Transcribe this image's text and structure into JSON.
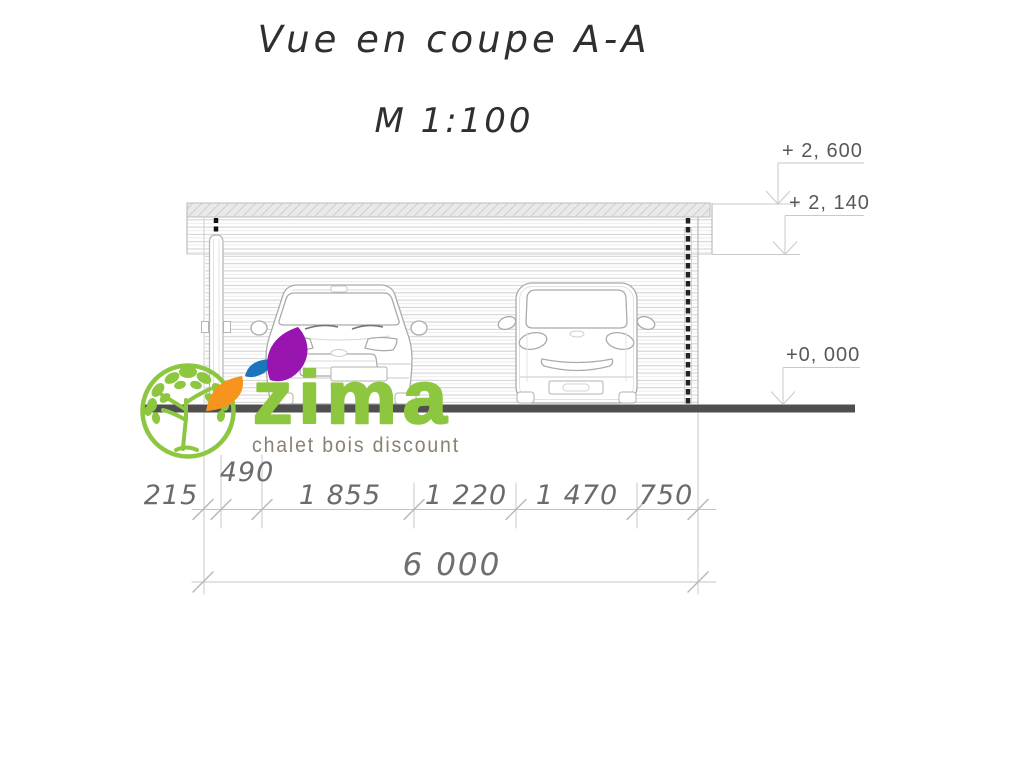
{
  "title": {
    "heading": "Vue en coupe A-A",
    "scale": "M 1:100"
  },
  "elevation_markers": [
    {
      "label": "+ 2, 600"
    },
    {
      "label": "+ 2, 140"
    },
    {
      "label": "+0, 000"
    }
  ],
  "dimensions": {
    "segments": [
      {
        "label": "215"
      },
      {
        "label": "490"
      },
      {
        "label": "1 855"
      },
      {
        "label": "1 220"
      },
      {
        "label": "1 470"
      },
      {
        "label": "750"
      }
    ],
    "total": {
      "label": "6 000"
    }
  },
  "logo": {
    "brand": "zima",
    "tagline": "chalet bois discount",
    "colors": {
      "green": "#8dc63f",
      "orange": "#f7941d",
      "blue": "#1b75bc",
      "purple": "#9816af",
      "tagline_text": "#8a8173"
    }
  },
  "drawing": {
    "ground_color": "#4f4f4f",
    "line_color": "#c4c4c4",
    "text_color": "#6b6b6b"
  }
}
